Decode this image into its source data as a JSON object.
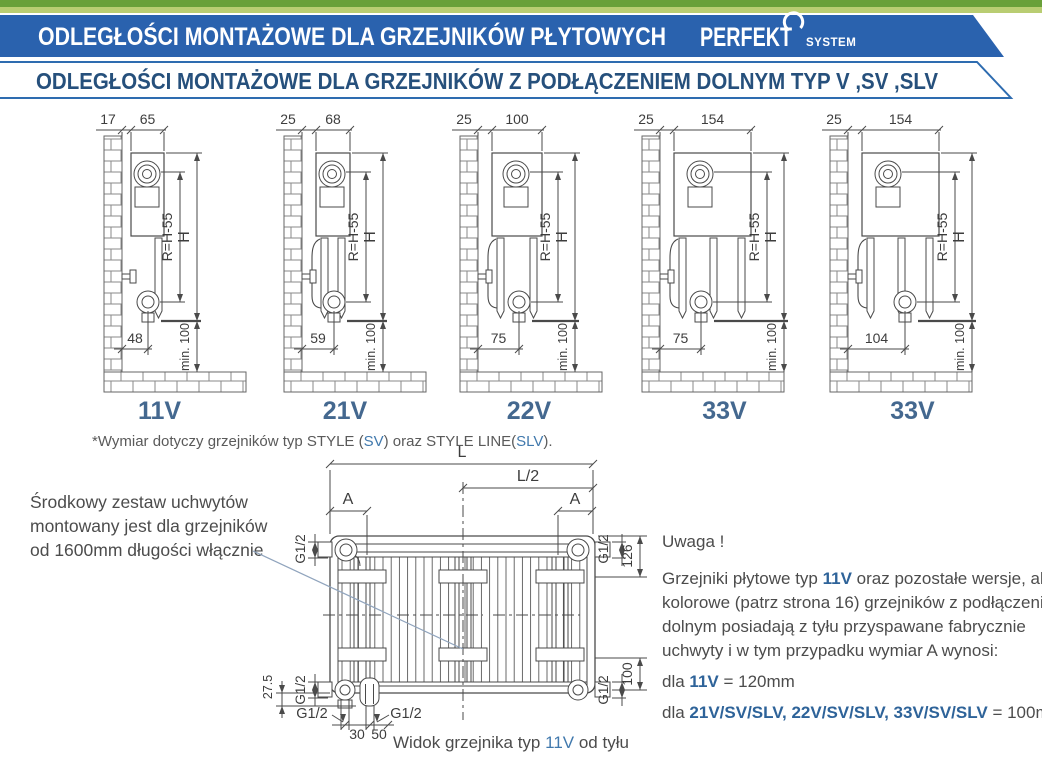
{
  "colors": {
    "banner_blue": "#2a62ae",
    "heading_blue": "#26507c",
    "caption_blue": "#44688f",
    "link_blue": "#4179ad",
    "inline_blue": "#2e6399",
    "green_dark": "#69a039",
    "green_light": "#b9cd72",
    "line_gray": "#4a4a4a",
    "leader_blue": "#90a4bd"
  },
  "header": {
    "title1": "ODLEGŁOŚCI  MONTAŻOWE  DLA GRZEJNIKÓW  PŁYTOWYCH",
    "logo_name": "PERFEKT",
    "logo_sub": "SYSTEM",
    "title2": "ODLEGŁOŚCI MONTAŻOWE DLA GRZEJNIKÓW Z PODŁĄCZENIEM DOLNYM TYP V ,SV ,SLV"
  },
  "diagrams": [
    {
      "label": "11V",
      "gap": "17",
      "depth": "65",
      "offset": "48",
      "radius_label": "R=H-55",
      "height_label": "H",
      "min_label": "min. 100"
    },
    {
      "label": "21V",
      "gap": "25",
      "depth": "68",
      "offset": "59",
      "radius_label": "R=H-55",
      "height_label": "H",
      "min_label": "min. 100"
    },
    {
      "label": "22V",
      "gap": "25",
      "depth": "100",
      "offset": "75",
      "radius_label": "R=H-55",
      "height_label": "H",
      "min_label": "min. 100"
    },
    {
      "label": "33V",
      "gap": "25",
      "depth": "154",
      "offset": "75",
      "radius_label": "R=H-55",
      "height_label": "H",
      "min_label": "min. 100"
    },
    {
      "label": "33V",
      "gap": "25",
      "depth": "154",
      "offset": "104",
      "radius_label": "R=H-55",
      "height_label": "H",
      "min_label": "min. 100"
    }
  ],
  "footnote": {
    "prefix": "*Wymiar dotyczy grzejników typ STYLE (",
    "sv": "SV",
    "mid": ") oraz STYLE LINE(",
    "slv": "SLV",
    "suffix": ")."
  },
  "left_note": {
    "lines": [
      "Środkowy zestaw uchwytów",
      "montowany jest dla grzejników",
      "od 1600mm długości włącznie"
    ]
  },
  "back_view": {
    "L": "L",
    "L2": "L/2",
    "A": "A",
    "g12": "G1/2",
    "d126": "126",
    "d100": "100",
    "d275": "27.5",
    "d30": "30",
    "d50": "50",
    "caption": {
      "pre": "Widok grzejnika typ ",
      "type": "11V",
      "post": " od tyłu"
    }
  },
  "notice": {
    "title": "Uwaga !",
    "p1a": "Grzejniki płytowe typ ",
    "p1b": "11V",
    "p1c": " oraz pozostałe wersje, ale",
    "line2": "kolorowe (patrz strona 16) grzejników z podłączeniem",
    "line3": "dolnym posiadają z tyłu przyspawane fabrycznie",
    "line4": "uchwyty i w tym przypadku wymiar A wynosi:",
    "l1a": "dla ",
    "l1b": "11V",
    "l1c": " = 120mm",
    "l2a": "dla ",
    "l2b": "21V/SV/SLV, 22V/SV/SLV, 33V/SV/SLV",
    "l2c": " = 100mm"
  }
}
